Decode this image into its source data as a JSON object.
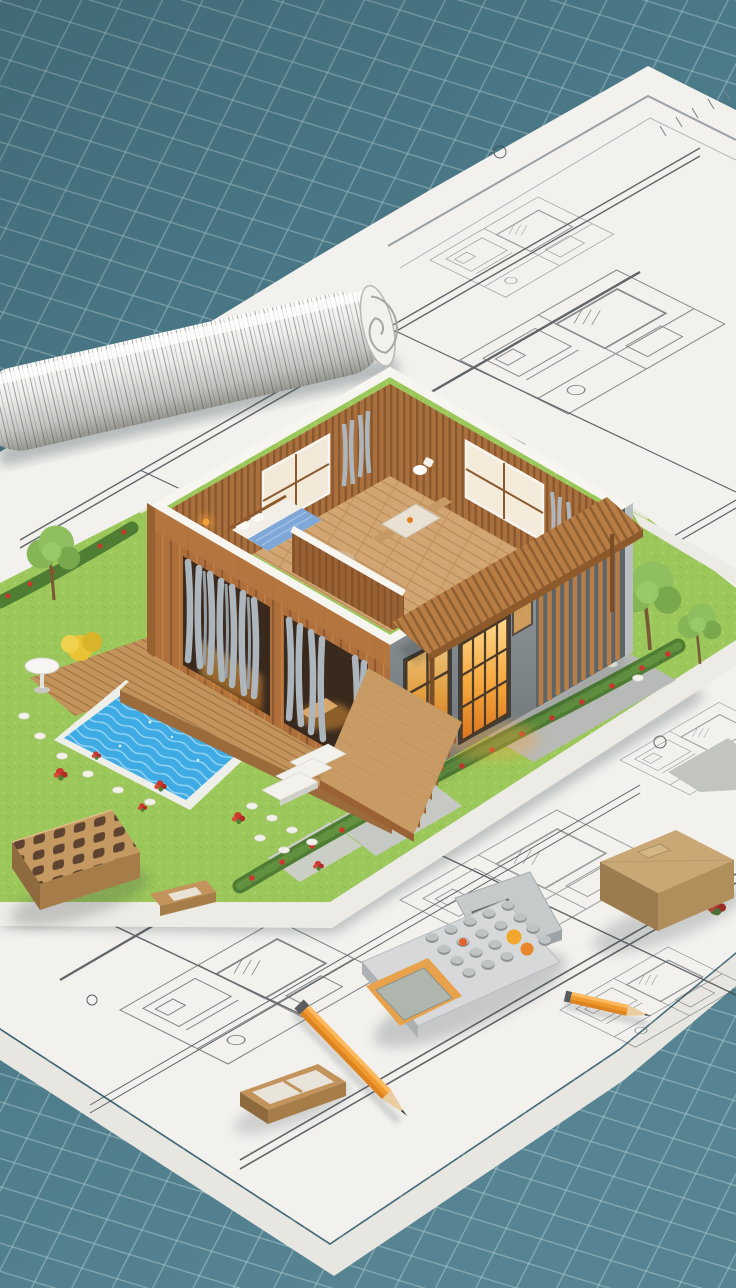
{
  "scene": {
    "type": "3d-architectural-render",
    "description": "Isometric cutaway model house with garden and pool standing on architectural blueprints laid over a teal grid cutting mat, with a rolled blueprint, perforated brick, calculators, pencils, wooden pieces and a cardboard block as props",
    "objects": [
      {
        "name": "cutting-mat",
        "detail": "teal mat with diagonal grid lines"
      },
      {
        "name": "blueprint-sheet-main",
        "detail": "white paper with dark plan linework"
      },
      {
        "name": "blueprint-roll",
        "detail": "rolled drawing, upper left"
      },
      {
        "name": "model-base",
        "detail": "white plinth with lawn top"
      },
      {
        "name": "pool",
        "detail": "blue water, wooden deck, white rim"
      },
      {
        "name": "garden",
        "detail": "trees, hedges with red flowers, stepping stones, round table"
      },
      {
        "name": "house",
        "detail": "cutaway wooden interior, gray concrete facade with louvers, glowing windows, pergola, entry stairs"
      },
      {
        "name": "perforated-brick",
        "detail": "tan brick with 15 holes"
      },
      {
        "name": "calculator",
        "detail": "gray body, orange framed display, orange keys"
      },
      {
        "name": "pencil",
        "detail": "orange drafting pencil"
      },
      {
        "name": "pencil-stub",
        "detail": "short orange pencil, lower right"
      },
      {
        "name": "cardboard-block",
        "detail": "tan box, right edge"
      },
      {
        "name": "wood-tray",
        "detail": "small open wooden box, bottom left"
      }
    ]
  },
  "palette": {
    "mat": "#4D7D8C",
    "mat_line": "#A6C6CC",
    "paper": "#F2F1EE",
    "paper_shade": "#E7E6E1",
    "ink": "#3E4347",
    "wood": "#AE6F3B",
    "wood_dark": "#8F5A2B",
    "wood_light": "#C2945C",
    "slat": "#B87C45",
    "floor": "#D2A673",
    "concrete": "#8A9194",
    "rim": "#F7F5F0",
    "lawn": "#9CC75A",
    "hedge": "#4F7D33",
    "flower": "#C9372E",
    "pool": "#3FABE4",
    "glow": "#F5A63B",
    "curtain": "#AEB6BD",
    "pencil": "#F0992E",
    "brick": "#C49A62",
    "cardboard": "#C9A876",
    "deck": "#C2945C",
    "calc_body": "#D6D8DA",
    "calc_accent": "#F2A62B"
  }
}
